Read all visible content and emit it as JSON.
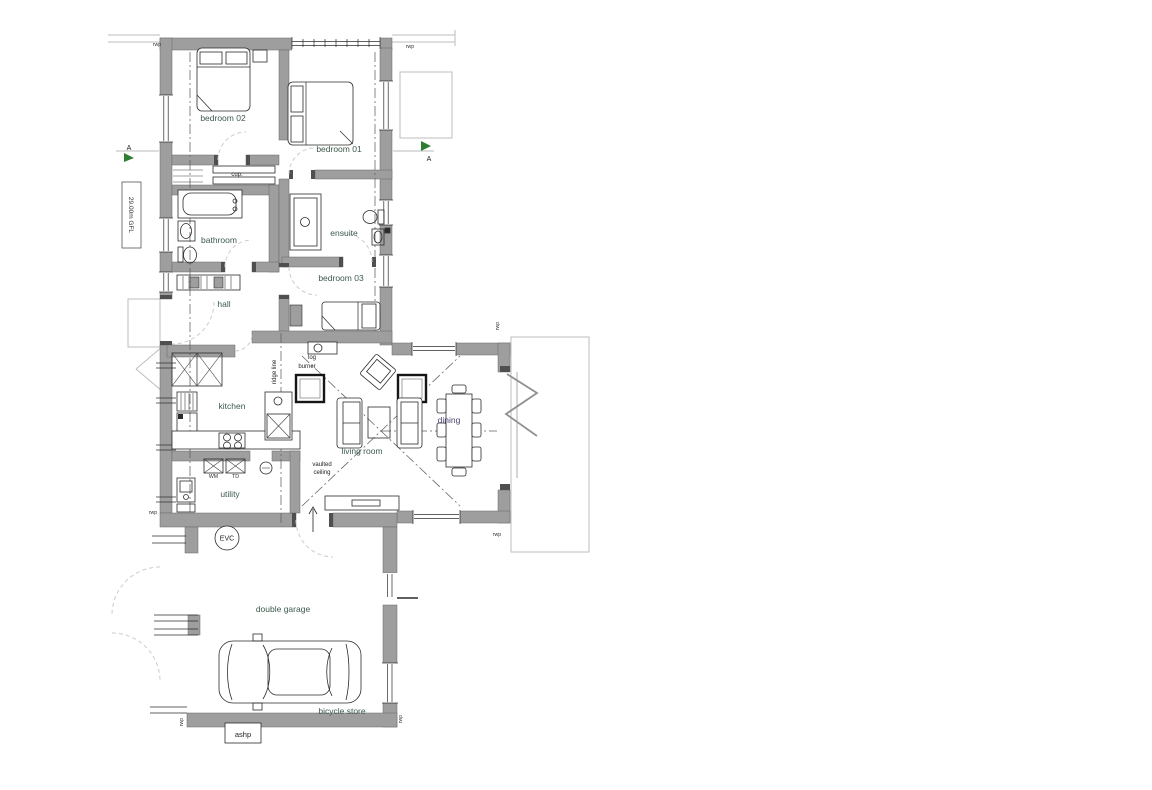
{
  "drawing": {
    "rooms": {
      "bedroom02": "bedroom 02",
      "bedroom01": "bedroom 01",
      "bedroom03": "bedroom 03",
      "bathroom": "bathroom",
      "ensuite": "ensuite",
      "hall": "hall",
      "kitchen": "kitchen",
      "utility": "utility",
      "living_room": "living room",
      "dining": "dining",
      "double_garage": "double garage",
      "bicycle_store": "bicycle store"
    },
    "annotations": {
      "cupboard": "cup.",
      "log": "log",
      "burner": "burner",
      "ridge_line": "ridge line",
      "vaulted": "vaulted",
      "ceiling": "ceiling",
      "wm": "WM",
      "td": "TD",
      "evc": "EVC",
      "ashp": "ashp",
      "rwp": "rwp",
      "gfl": "29.00m GFL",
      "section_marker": "A"
    },
    "colors": {
      "wall": "#9e9e9e",
      "room_label": "#3d5a4b",
      "dining_label": "#4c4273",
      "annotation": "#222222",
      "section_arrow": "#2f7d32",
      "boundary": "#bdbdbd"
    }
  }
}
